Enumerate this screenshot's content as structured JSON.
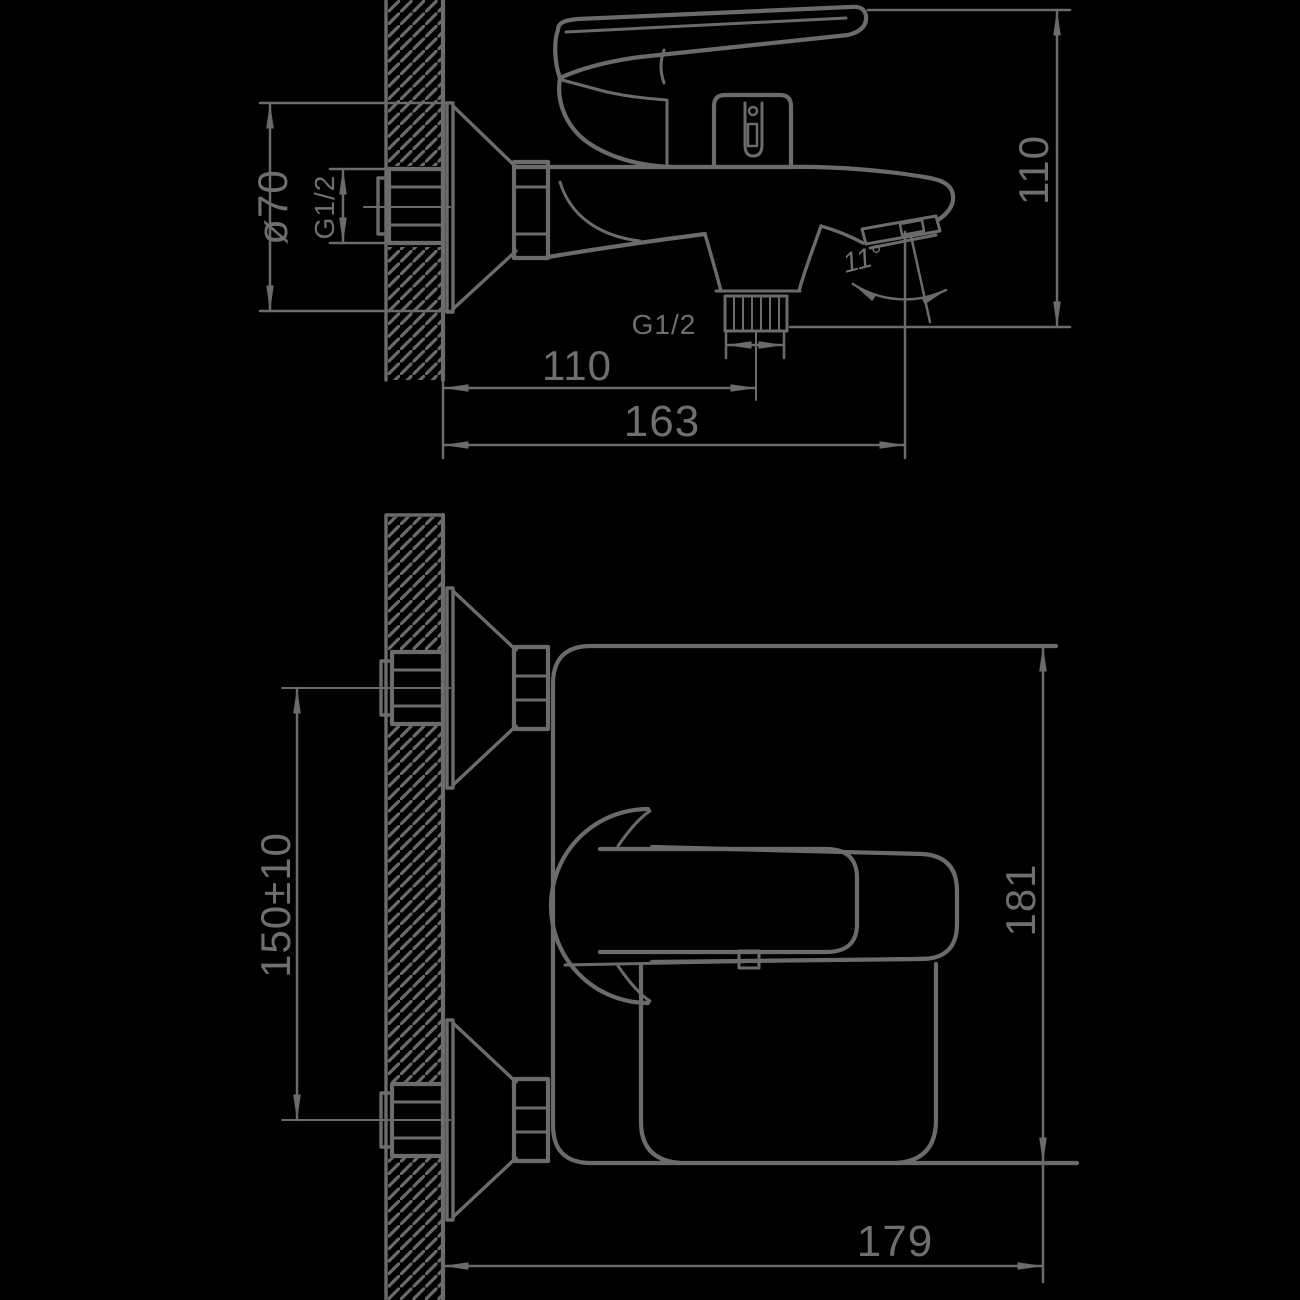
{
  "colors": {
    "background": "#000000",
    "line": "#6b6b6b",
    "text": "#6f6f6f"
  },
  "drawing_type": "bath-shower mixer installation dimensions, two orthographic views",
  "dimensions": {
    "side_view": {
      "escutcheon_diameter": "ø70",
      "inlet_thread": "G1/2",
      "outlet_thread": "G1/2",
      "overall_height": "110",
      "wall_to_outlet": "110",
      "wall_to_spout_tip": "163",
      "spout_angle": "11°"
    },
    "front_view": {
      "inlet_spacing": "150±10",
      "overall_height": "181",
      "overall_depth": "179"
    }
  }
}
